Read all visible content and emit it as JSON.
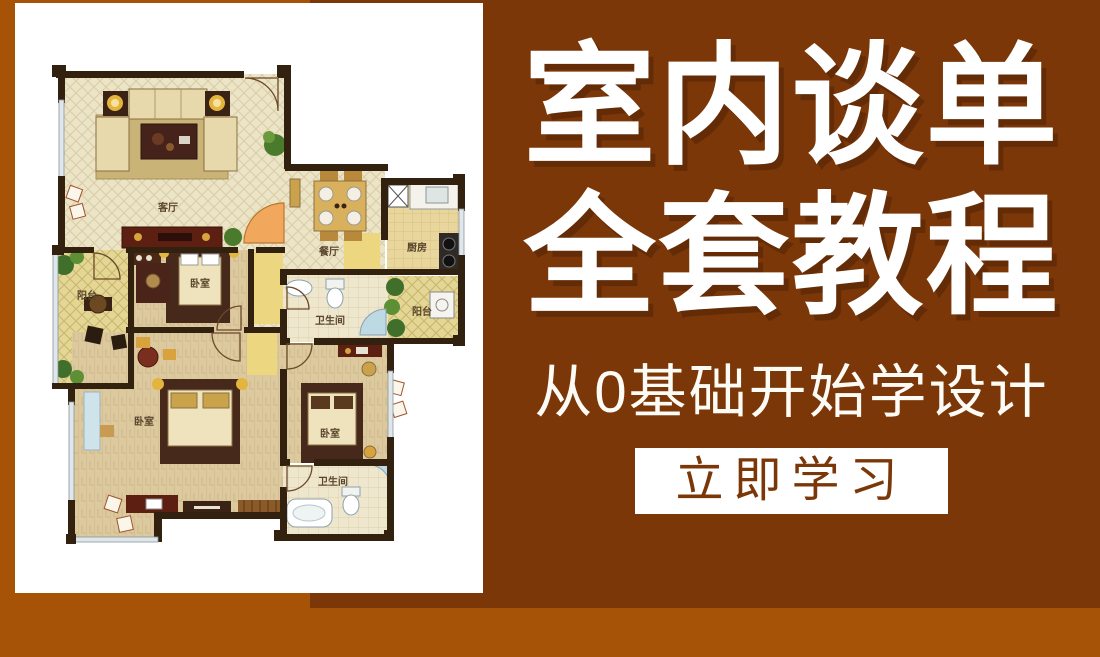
{
  "page": {
    "colors": {
      "background_orange": "#a65307",
      "panel_brown": "#7b3708",
      "card_white": "#ffffff",
      "title_white": "#ffffff",
      "cta_text_brown": "#7b3708",
      "door_accent_orange": "#f2a85c"
    }
  },
  "hero": {
    "title_line1": "室内谈单",
    "title_line2": "全套教程",
    "subtitle": "从0基础开始学设计",
    "cta_label": "立即学习"
  },
  "floor_plan": {
    "rooms": [
      {
        "id": "living-room",
        "label": "客厅"
      },
      {
        "id": "dining-room",
        "label": "餐厅"
      },
      {
        "id": "kitchen",
        "label": "厨房"
      },
      {
        "id": "balcony-left",
        "label": "阳台"
      },
      {
        "id": "bedroom-top",
        "label": "卧室"
      },
      {
        "id": "bathroom-top",
        "label": "卫生间"
      },
      {
        "id": "balcony-right",
        "label": "阳台"
      },
      {
        "id": "bedroom-main",
        "label": "卧室"
      },
      {
        "id": "bedroom-right",
        "label": "卧室"
      },
      {
        "id": "bathroom-bottom",
        "label": "卫生间"
      }
    ]
  }
}
